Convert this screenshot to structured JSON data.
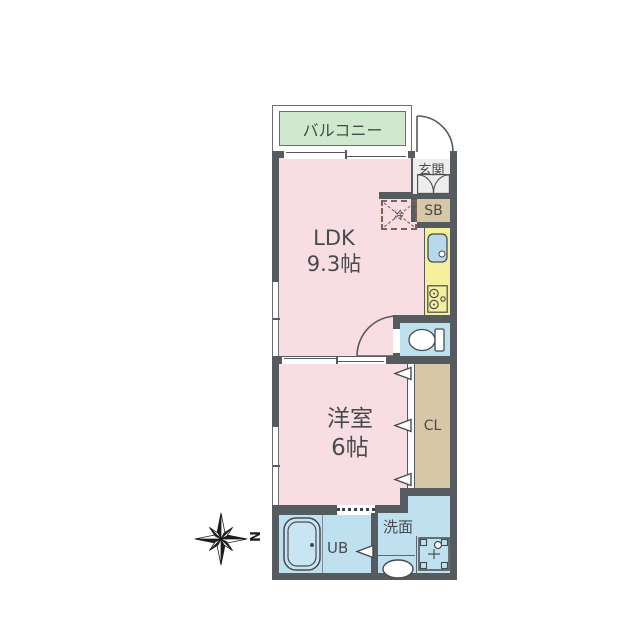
{
  "title": "floor-plan",
  "rooms": {
    "balcony": {
      "label": "バルコニー"
    },
    "ldk": {
      "label": "LDK",
      "size": "9.3帖"
    },
    "genkan": {
      "label": "玄関"
    },
    "shoe_box": {
      "label": "SB"
    },
    "refrigerator": {
      "label": "冷"
    },
    "western_room": {
      "label": "洋室",
      "size": "6帖"
    },
    "closet": {
      "label": "CL"
    },
    "unit_bath": {
      "label": "UB"
    },
    "washroom": {
      "label": "洗面"
    }
  },
  "compass": {
    "north_label": "N"
  },
  "colors": {
    "wall": "#565b60",
    "room_pink": "#f8dde3",
    "balcony_green": "#cfe9cf",
    "water_blue": "#bfe1ef",
    "kitchen_yellow": "#f6ef9e",
    "storage_tan": "#d8c7a7",
    "entry_gray": "#ededed",
    "fridge_dash": "#7d6156",
    "text": "#474b4f"
  }
}
